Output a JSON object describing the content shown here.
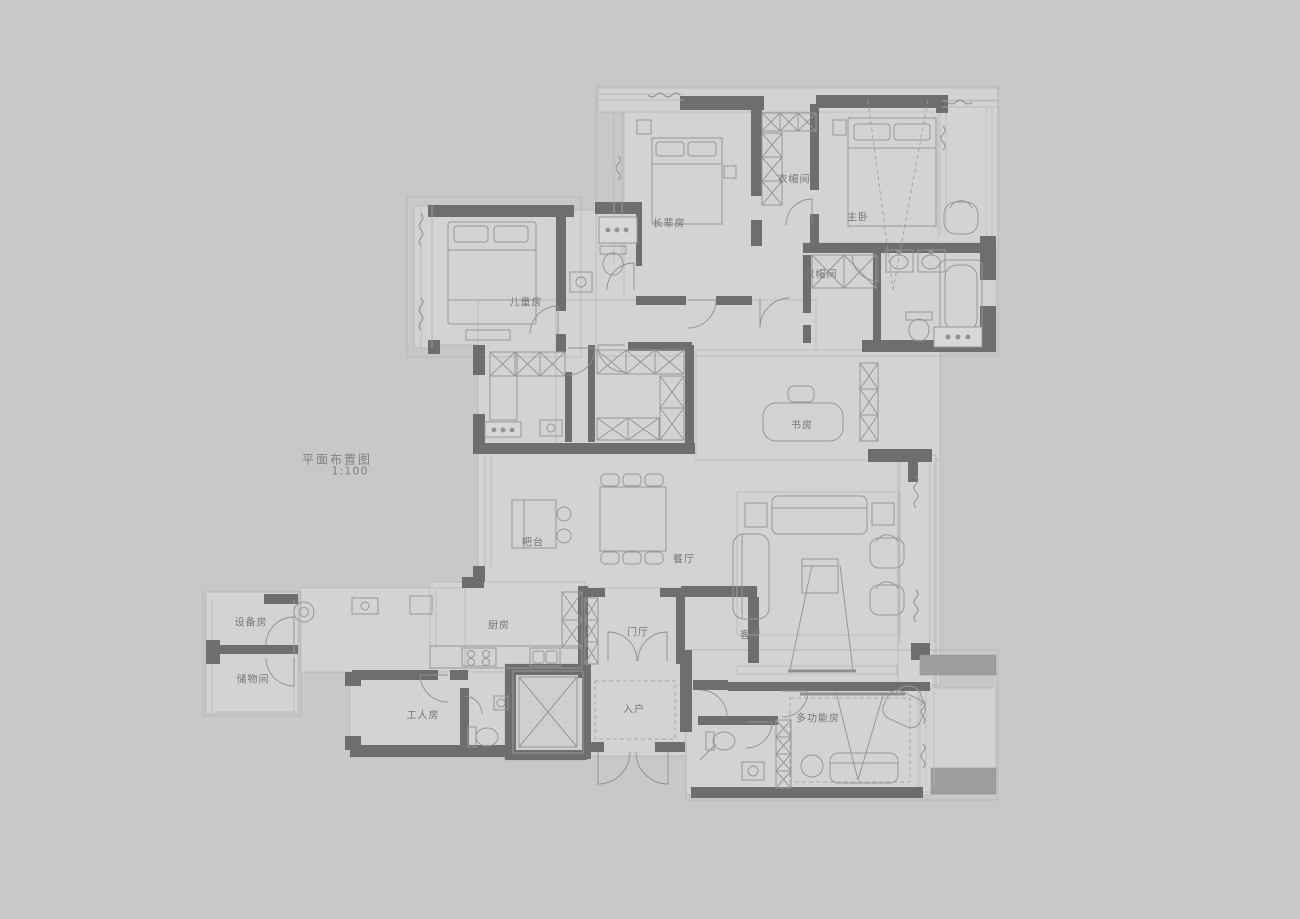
{
  "title": {
    "name": "平面布置图",
    "scale": "1:100"
  },
  "colors": {
    "background": "#c8c8c8",
    "floor": "#d3d3d3",
    "wall": "#6e6e6e",
    "furniture_line": "#979797",
    "label_text": "#757575"
  },
  "rooms": {
    "children_room": {
      "label": "儿童房"
    },
    "elder_room": {
      "label": "长辈房"
    },
    "cloakroom_top": {
      "label": "衣帽间"
    },
    "master_bedroom": {
      "label": "主卧"
    },
    "cloakroom_master": {
      "label": "衣帽间"
    },
    "study": {
      "label": "书房"
    },
    "bar": {
      "label": "吧台"
    },
    "dining_room": {
      "label": "餐厅"
    },
    "living_room": {
      "label": "客厅"
    },
    "kitchen": {
      "label": "厨房"
    },
    "foyer": {
      "label": "门厅"
    },
    "entry": {
      "label": "入户"
    },
    "worker_room": {
      "label": "工人房"
    },
    "equipment_room": {
      "label": "设备房"
    },
    "storage_room": {
      "label": "储物间"
    },
    "multi_function_room": {
      "label": "多功能房"
    }
  }
}
